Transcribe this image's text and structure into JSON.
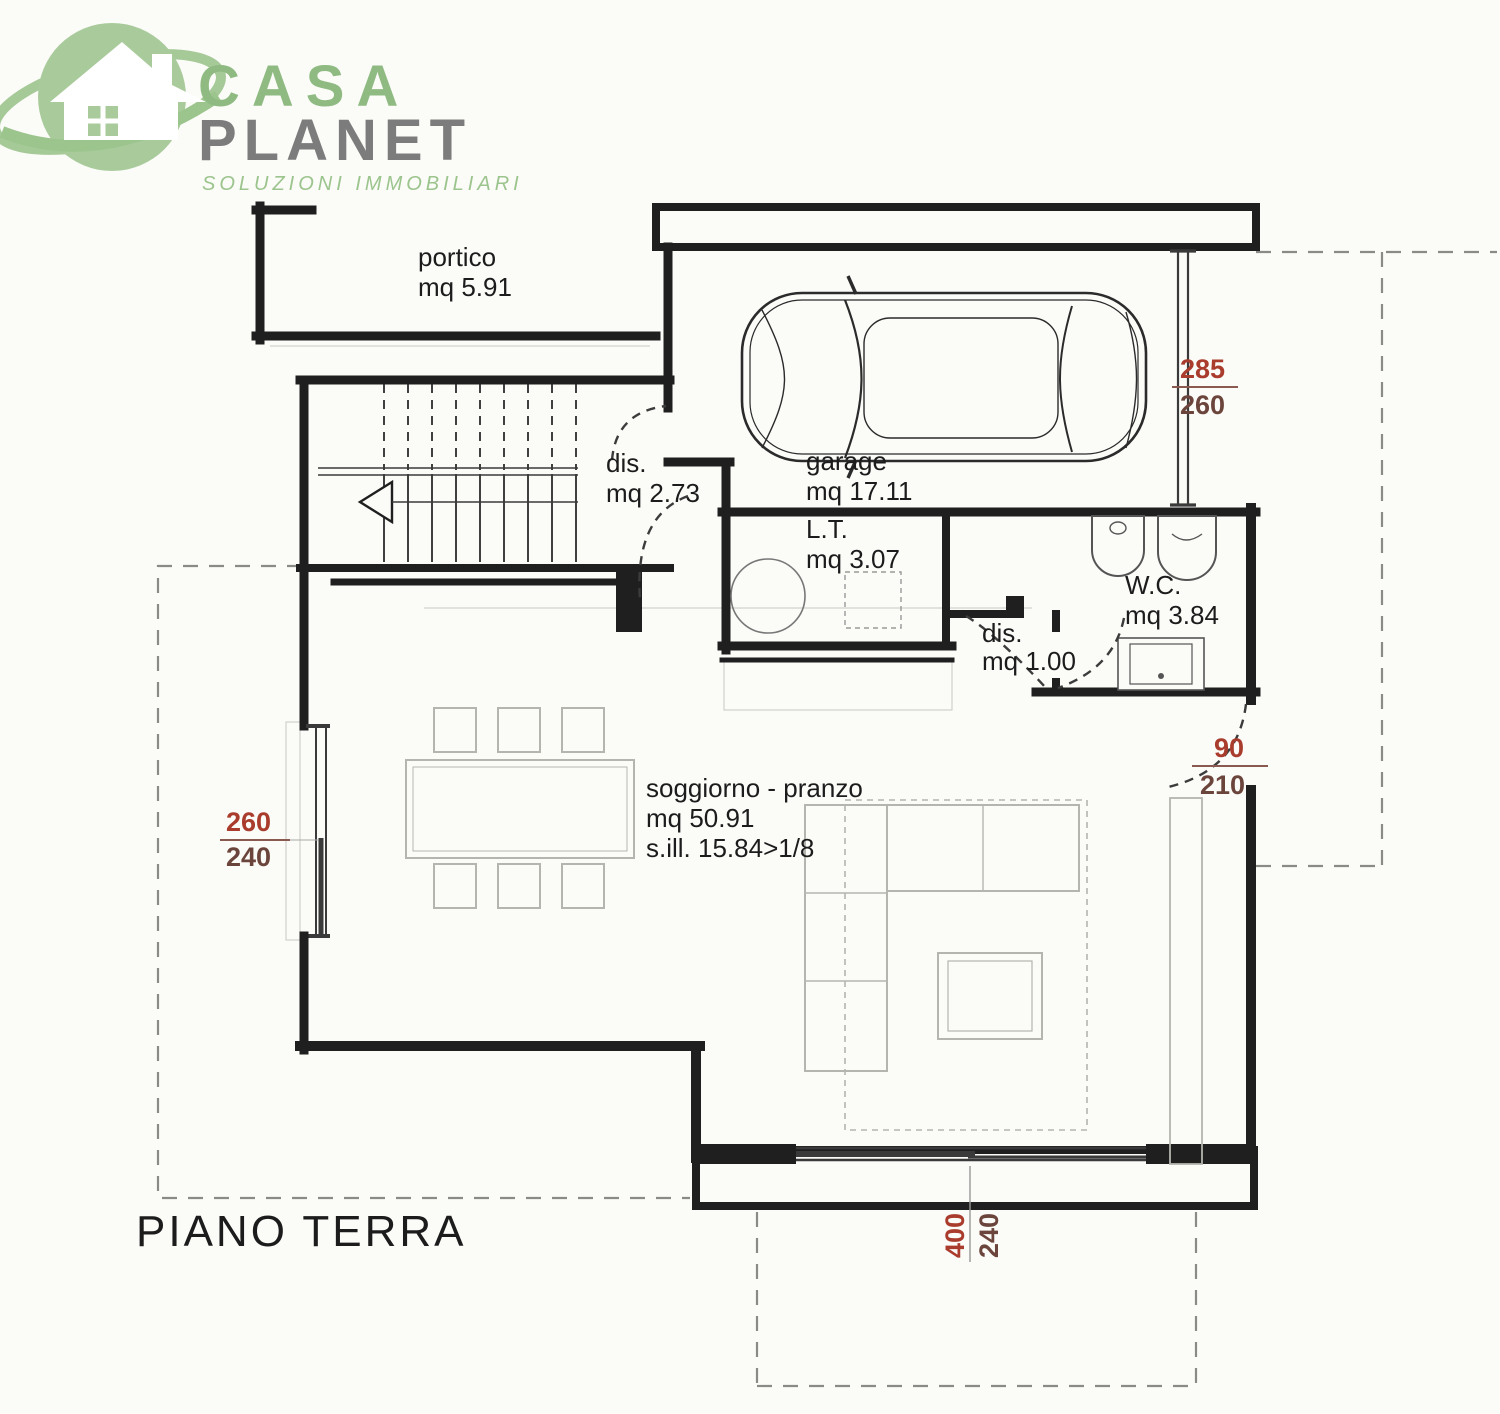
{
  "logo": {
    "name1": "CASA",
    "name2": "PLANET",
    "tagline": "SOLUZIONI IMMOBILIARI",
    "green": "#a6c998",
    "gray": "#7c7c7c"
  },
  "title": "PIANO TERRA",
  "rooms": {
    "portico": {
      "label": "portico",
      "area": "mq 5.91"
    },
    "dis1": {
      "label": "dis.",
      "area": "mq 2.73"
    },
    "garage": {
      "label": "garage",
      "area": "mq 17.11"
    },
    "lt": {
      "label": "L.T.",
      "area": "mq 3.07"
    },
    "wc": {
      "label": "W.C.",
      "area": "mq 3.84"
    },
    "dis2": {
      "label": "dis.",
      "area": "mq 1.00"
    },
    "soggiorno": {
      "label": "soggiorno - pranzo",
      "area": "mq 50.91",
      "sill": "s.ill. 15.84>1/8"
    }
  },
  "dims": {
    "garage_door": {
      "top": "285",
      "bottom": "260"
    },
    "right_door": {
      "top": "90",
      "bottom": "210"
    },
    "left_window": {
      "top": "260",
      "bottom": "240"
    },
    "bottom_window": {
      "top": "400",
      "bottom": "240"
    }
  },
  "colors": {
    "wall": "#1f1f1f",
    "dimension_red": "#a93c2c"
  }
}
